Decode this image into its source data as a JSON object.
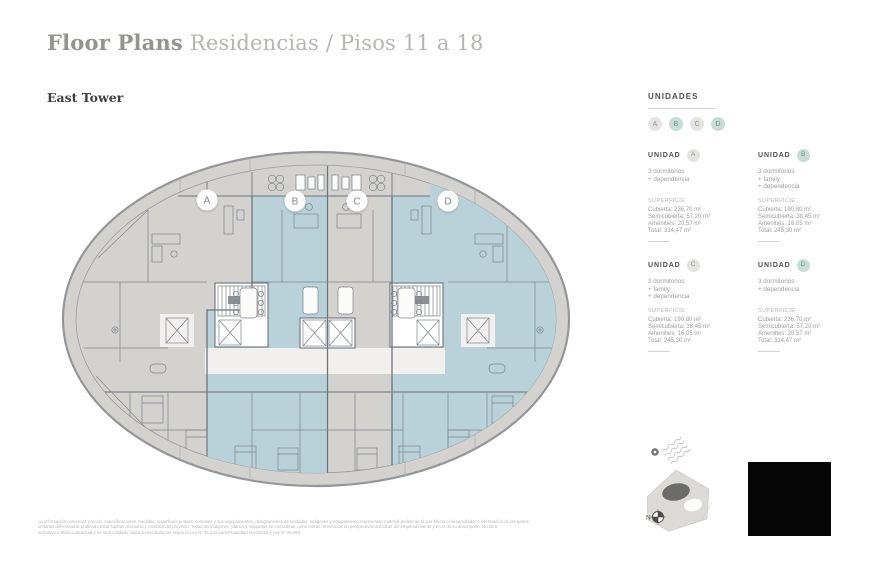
{
  "page": {
    "title_primary": "Floor Plans",
    "title_secondary": "Residencias / Pisos 11 a 18",
    "tower_label": "East Tower"
  },
  "legend": {
    "heading": "UNIDADES",
    "badges": [
      {
        "label": "A",
        "variant": "gray"
      },
      {
        "label": "B",
        "variant": "teal"
      },
      {
        "label": "C",
        "variant": "gray"
      },
      {
        "label": "D",
        "variant": "teal"
      }
    ]
  },
  "units": [
    {
      "name_label": "UNIDAD",
      "letter": "A",
      "variant": "gray",
      "features": [
        "3 dormitorios",
        "+ dependencia"
      ],
      "superficie_label": "SUPERFICIE",
      "metrics": [
        "Cubierta: 236,70 m²",
        "Semicubierta: 57,20 m²",
        "Amenities: 20,57 m²",
        "Total: 314,47 m²"
      ]
    },
    {
      "name_label": "UNIDAD",
      "letter": "B",
      "variant": "teal",
      "features": [
        "3 dormitorios",
        "+ family",
        "+ dependencia"
      ],
      "superficie_label": "SUPERFICIE",
      "metrics": [
        "Cubierta: 190,80 m²",
        "Semicubierta: 38,45 m²",
        "Amenities: 16,05 m²",
        "Total: 245,30 m²"
      ]
    },
    {
      "name_label": "UNIDAD",
      "letter": "C",
      "variant": "gray",
      "features": [
        "3 dormitorios",
        "+ family",
        "+ dependencia"
      ],
      "superficie_label": "SUPERFICIE",
      "metrics": [
        "Cubierta: 190,80 m²",
        "Semicubierta: 38,45 m²",
        "Amenities: 16,05 m²",
        "Total: 245,30 m²"
      ]
    },
    {
      "name_label": "UNIDAD",
      "letter": "D",
      "variant": "teal",
      "features": [
        "3 dormitorios",
        "+ dependencia"
      ],
      "superficie_label": "SUPERFICIE",
      "metrics": [
        "Cubierta: 236,70 m²",
        "Semicubierta: 57,20 m²",
        "Amenities: 20,57 m²",
        "Total: 314,47 m²"
      ]
    }
  ],
  "plan": {
    "markers": [
      {
        "label": "A"
      },
      {
        "label": "B"
      },
      {
        "label": "C"
      },
      {
        "label": "D"
      }
    ],
    "compass_label": "N"
  },
  "disclaimer": {
    "lines": [
      "La información comercial, precios, especificaciones, medidas, superficies propias, comunes y sus equipamientos, designaciones de unidades, imágenes y equipamiento representan material preliminar al que afecta el desarrollador e información de las partes",
      "unitarias del inmueble pudiendo estar sujetas al reinicio y cambios del proyecto. Todas las imágenes, planos y maquetas se consideran como meras referencias en perspectivas artísticas del emprendimiento y en sí de su descripción. No será",
      "indicativo a título contractual y no será validado hasta su escrituración según la Ley N° 25.243 para Propiedad Horizontal y Ley N° 26.994."
    ]
  },
  "colors": {
    "unit_blue": "#b9d2da",
    "unit_gray": "#d3d2cf",
    "ring_stroke": "#94979a",
    "wall": "#6e747b",
    "wall_light": "#7d838a",
    "badge_teal_bg": "#c7ddd7",
    "badge_teal_text": "#6f8f88",
    "badge_gray_bg": "#e4e4e2",
    "badge_gray_text": "#8f8f8d",
    "title_primary": "#95938f",
    "title_secondary": "#b7b5b1",
    "text_dark": "#4f4f4d",
    "text_mid": "#9c9c9a",
    "text_light": "#b3b3b1"
  }
}
